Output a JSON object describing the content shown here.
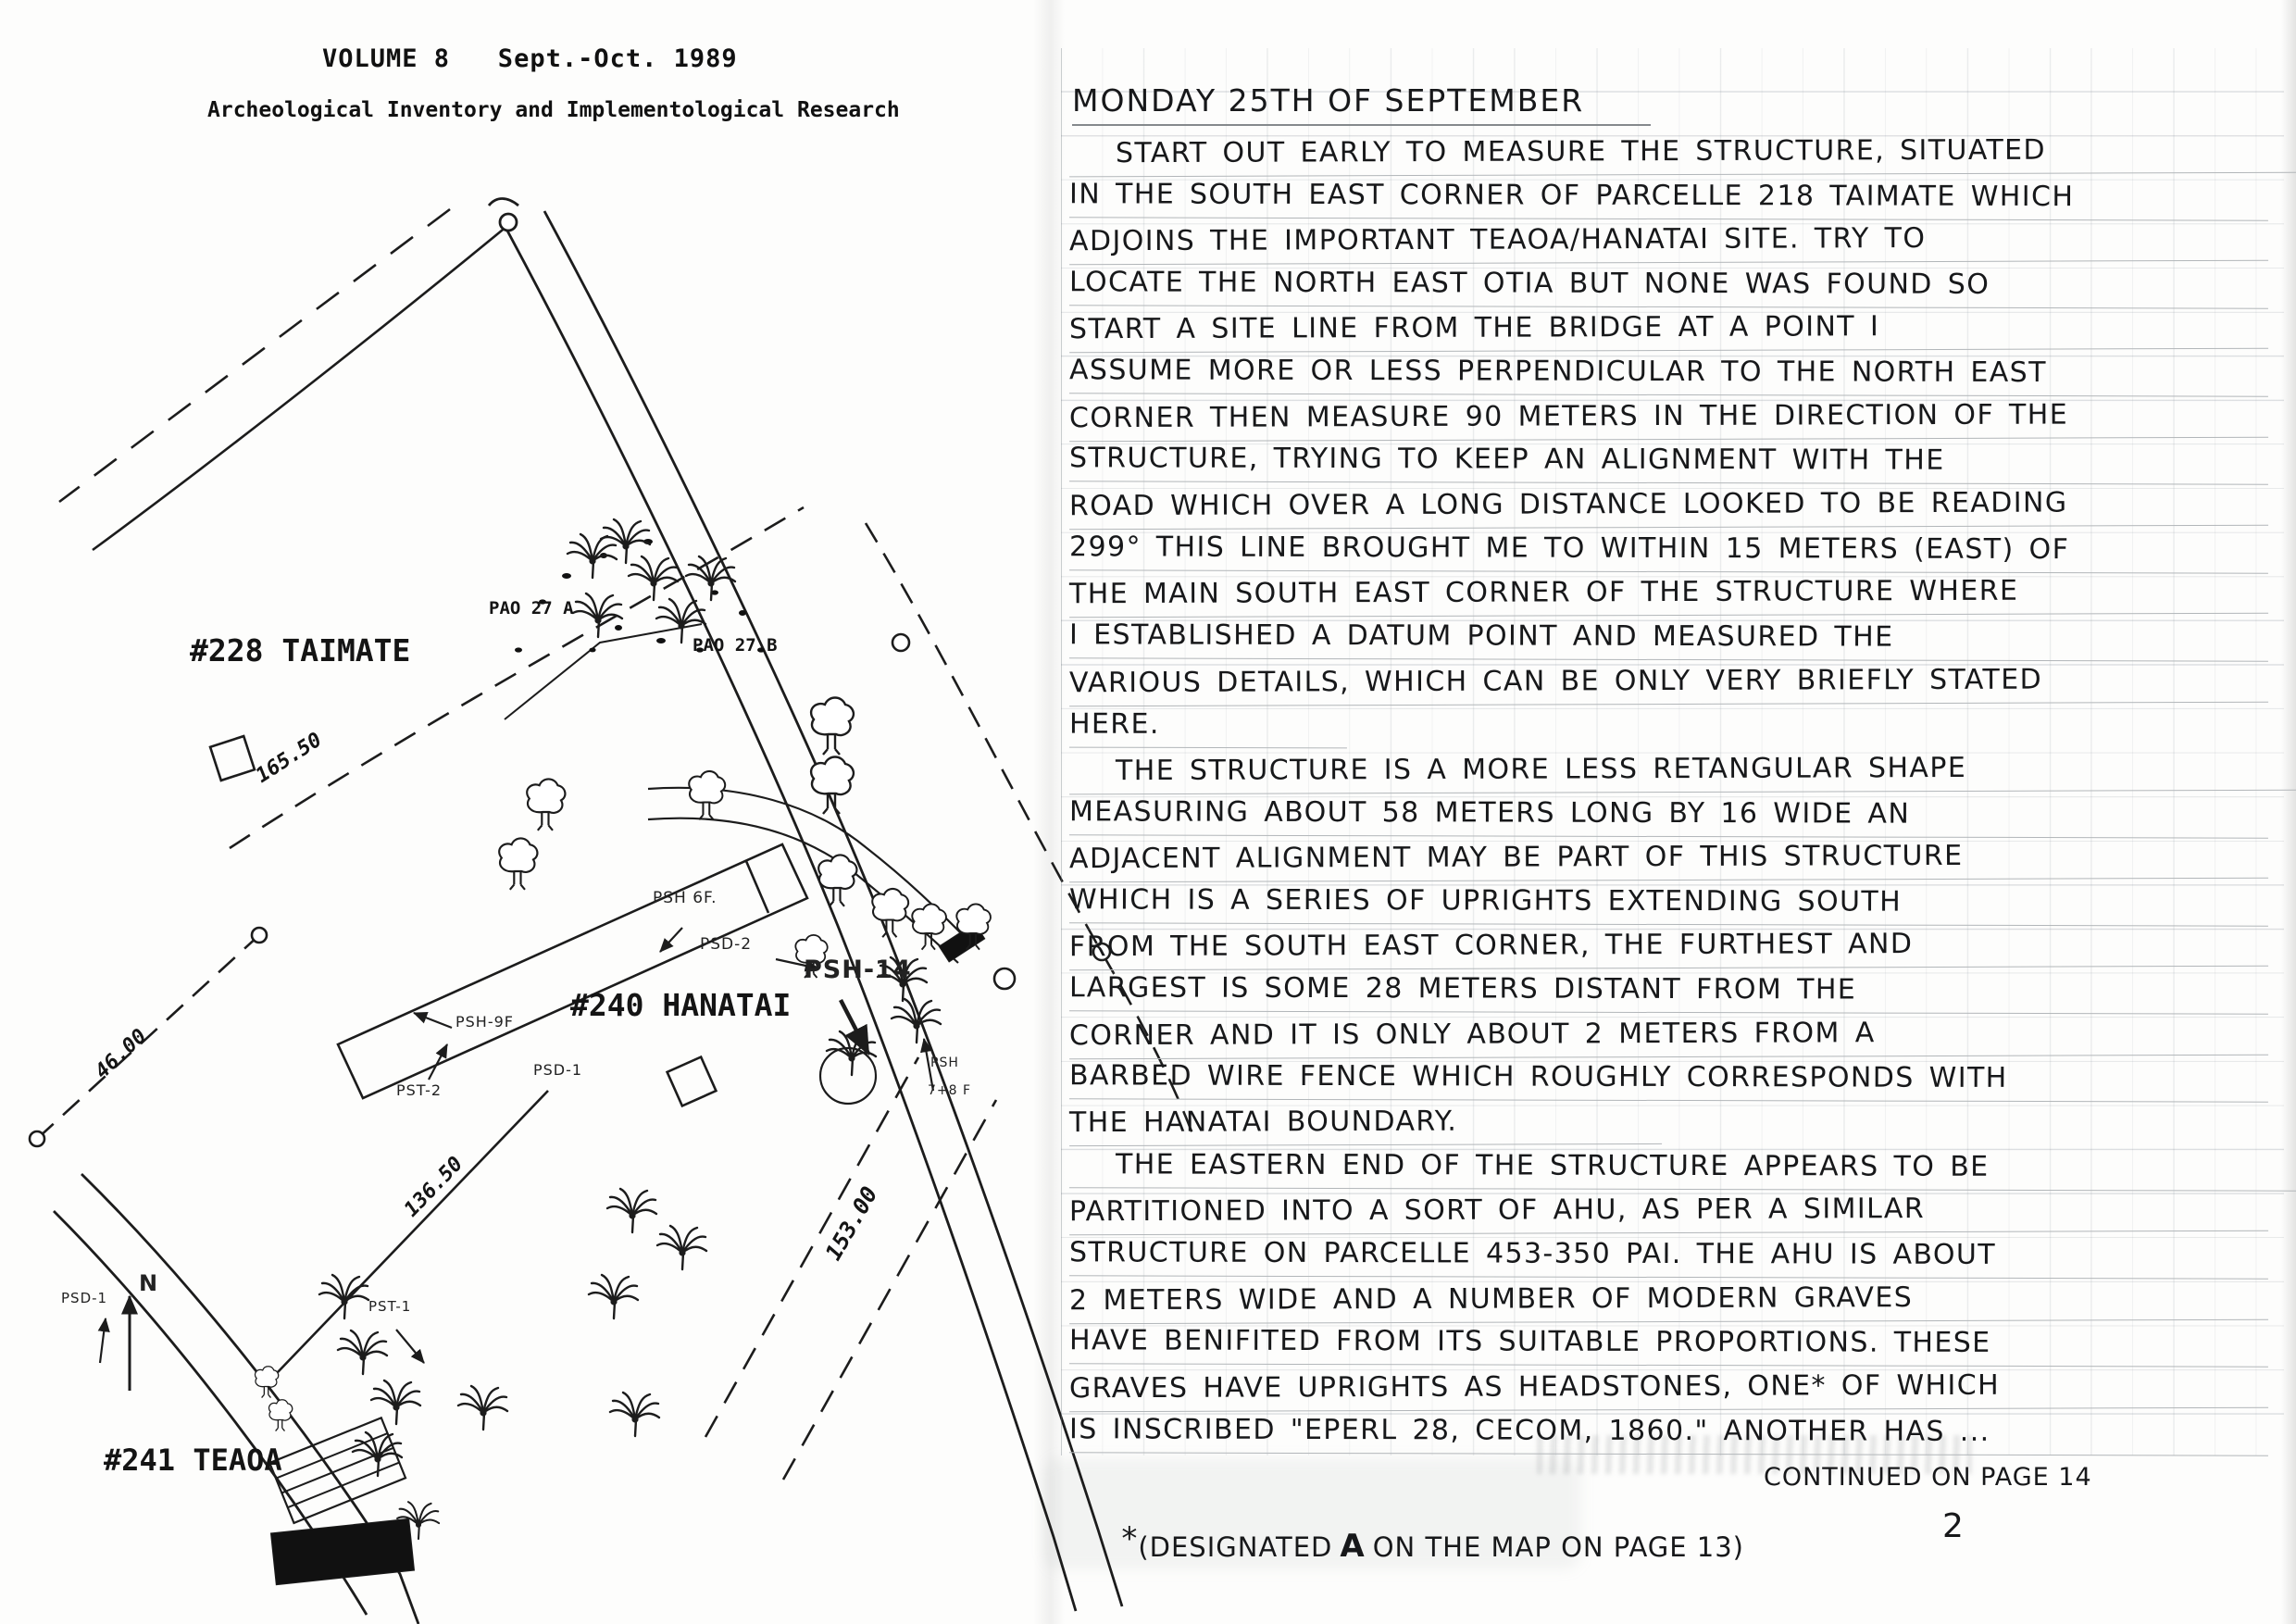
{
  "header": {
    "volume_title": "VOLUME 8   Sept.-Oct. 1989",
    "subtitle": "Archeological Inventory and Implementological Research"
  },
  "map": {
    "parcel_228": "#228 TAIMATE",
    "parcel_240": "#240 HANATAI",
    "parcel_241": "#241 TEAOA",
    "pao_27a": "PAO 27 A",
    "pao_27b": "PAO 27 B",
    "psh_6f": "PSH 6F.",
    "psd_2": "PSD-2",
    "psh_14": "PSH-14",
    "psh_9f": "PSH-9F",
    "pst_2": "PST-2",
    "psd_1": "PSD-1",
    "psh_78_line1": "PSH",
    "psh_78_line2": "7+8 F",
    "pst_1": "PST-1",
    "psd_1b": "PSD-1",
    "north": "N",
    "dim_165": "165.50",
    "dim_46": "46.00",
    "dim_136": "136.50",
    "dim_153": "153.00"
  },
  "notes": {
    "date_heading": "MONDAY 25TH OF SEPTEMBER",
    "lines": [
      "START OUT EARLY TO MEASURE THE STRUCTURE, SITUATED",
      "IN THE SOUTH EAST CORNER OF PARCELLE 218 TAIMATE WHICH",
      "ADJOINS THE IMPORTANT TEAOA/HANATAI SITE. TRY TO",
      "LOCATE THE NORTH EAST OTIA BUT NONE WAS FOUND SO",
      "START A SITE LINE FROM THE BRIDGE AT A POINT I",
      "ASSUME MORE OR LESS PERPENDICULAR TO THE NORTH EAST",
      "CORNER THEN MEASURE 90 METERS IN THE DIRECTION OF THE",
      "STRUCTURE, TRYING TO KEEP AN ALIGNMENT WITH THE",
      "ROAD WHICH OVER A LONG DISTANCE LOOKED TO BE READING",
      "299° THIS LINE BROUGHT ME TO WITHIN 15 METERS (EAST) OF",
      "THE MAIN SOUTH EAST CORNER OF THE STRUCTURE WHERE",
      "I ESTABLISHED A DATUM POINT AND MEASURED THE",
      "VARIOUS DETAILS, WHICH CAN BE ONLY VERY BRIEFLY STATED",
      "HERE.",
      "THE STRUCTURE IS A MORE LESS RETANGULAR SHAPE",
      "MEASURING ABOUT 58 METERS LONG BY 16 WIDE AN",
      "ADJACENT ALIGNMENT MAY BE PART OF THIS STRUCTURE",
      "WHICH IS A SERIES OF UPRIGHTS EXTENDING SOUTH",
      "FROM THE SOUTH EAST CORNER, THE FURTHEST AND",
      "LARGEST IS SOME 28 METERS DISTANT FROM THE",
      "CORNER AND IT IS ONLY ABOUT 2 METERS FROM A",
      "BARBED WIRE FENCE WHICH ROUGHLY CORRESPONDS WITH",
      "THE HANATAI BOUNDARY.",
      "THE EASTERN END OF THE STRUCTURE APPEARS TO BE",
      "PARTITIONED INTO A SORT OF AHU, AS PER A SIMILAR",
      "STRUCTURE ON PARCELLE 453-350 PAI. THE AHU IS ABOUT",
      "2 METERS WIDE AND A NUMBER OF MODERN GRAVES",
      "HAVE BENIFITED FROM ITS SUITABLE PROPORTIONS. THESE",
      "GRAVES HAVE UPRIGHTS AS HEADSTONES, ONE* OF WHICH",
      "IS INSCRIBED \"EPERL 28, CECOM, 1860.\" ANOTHER HAS ..."
    ],
    "continued_note": "CONTINUED ON PAGE 14",
    "footnote_star": "*",
    "footnote_open": "(DESIGNATED",
    "footnote_a": "A",
    "footnote_close": "ON THE MAP ON PAGE 13)",
    "page_number": "2"
  }
}
